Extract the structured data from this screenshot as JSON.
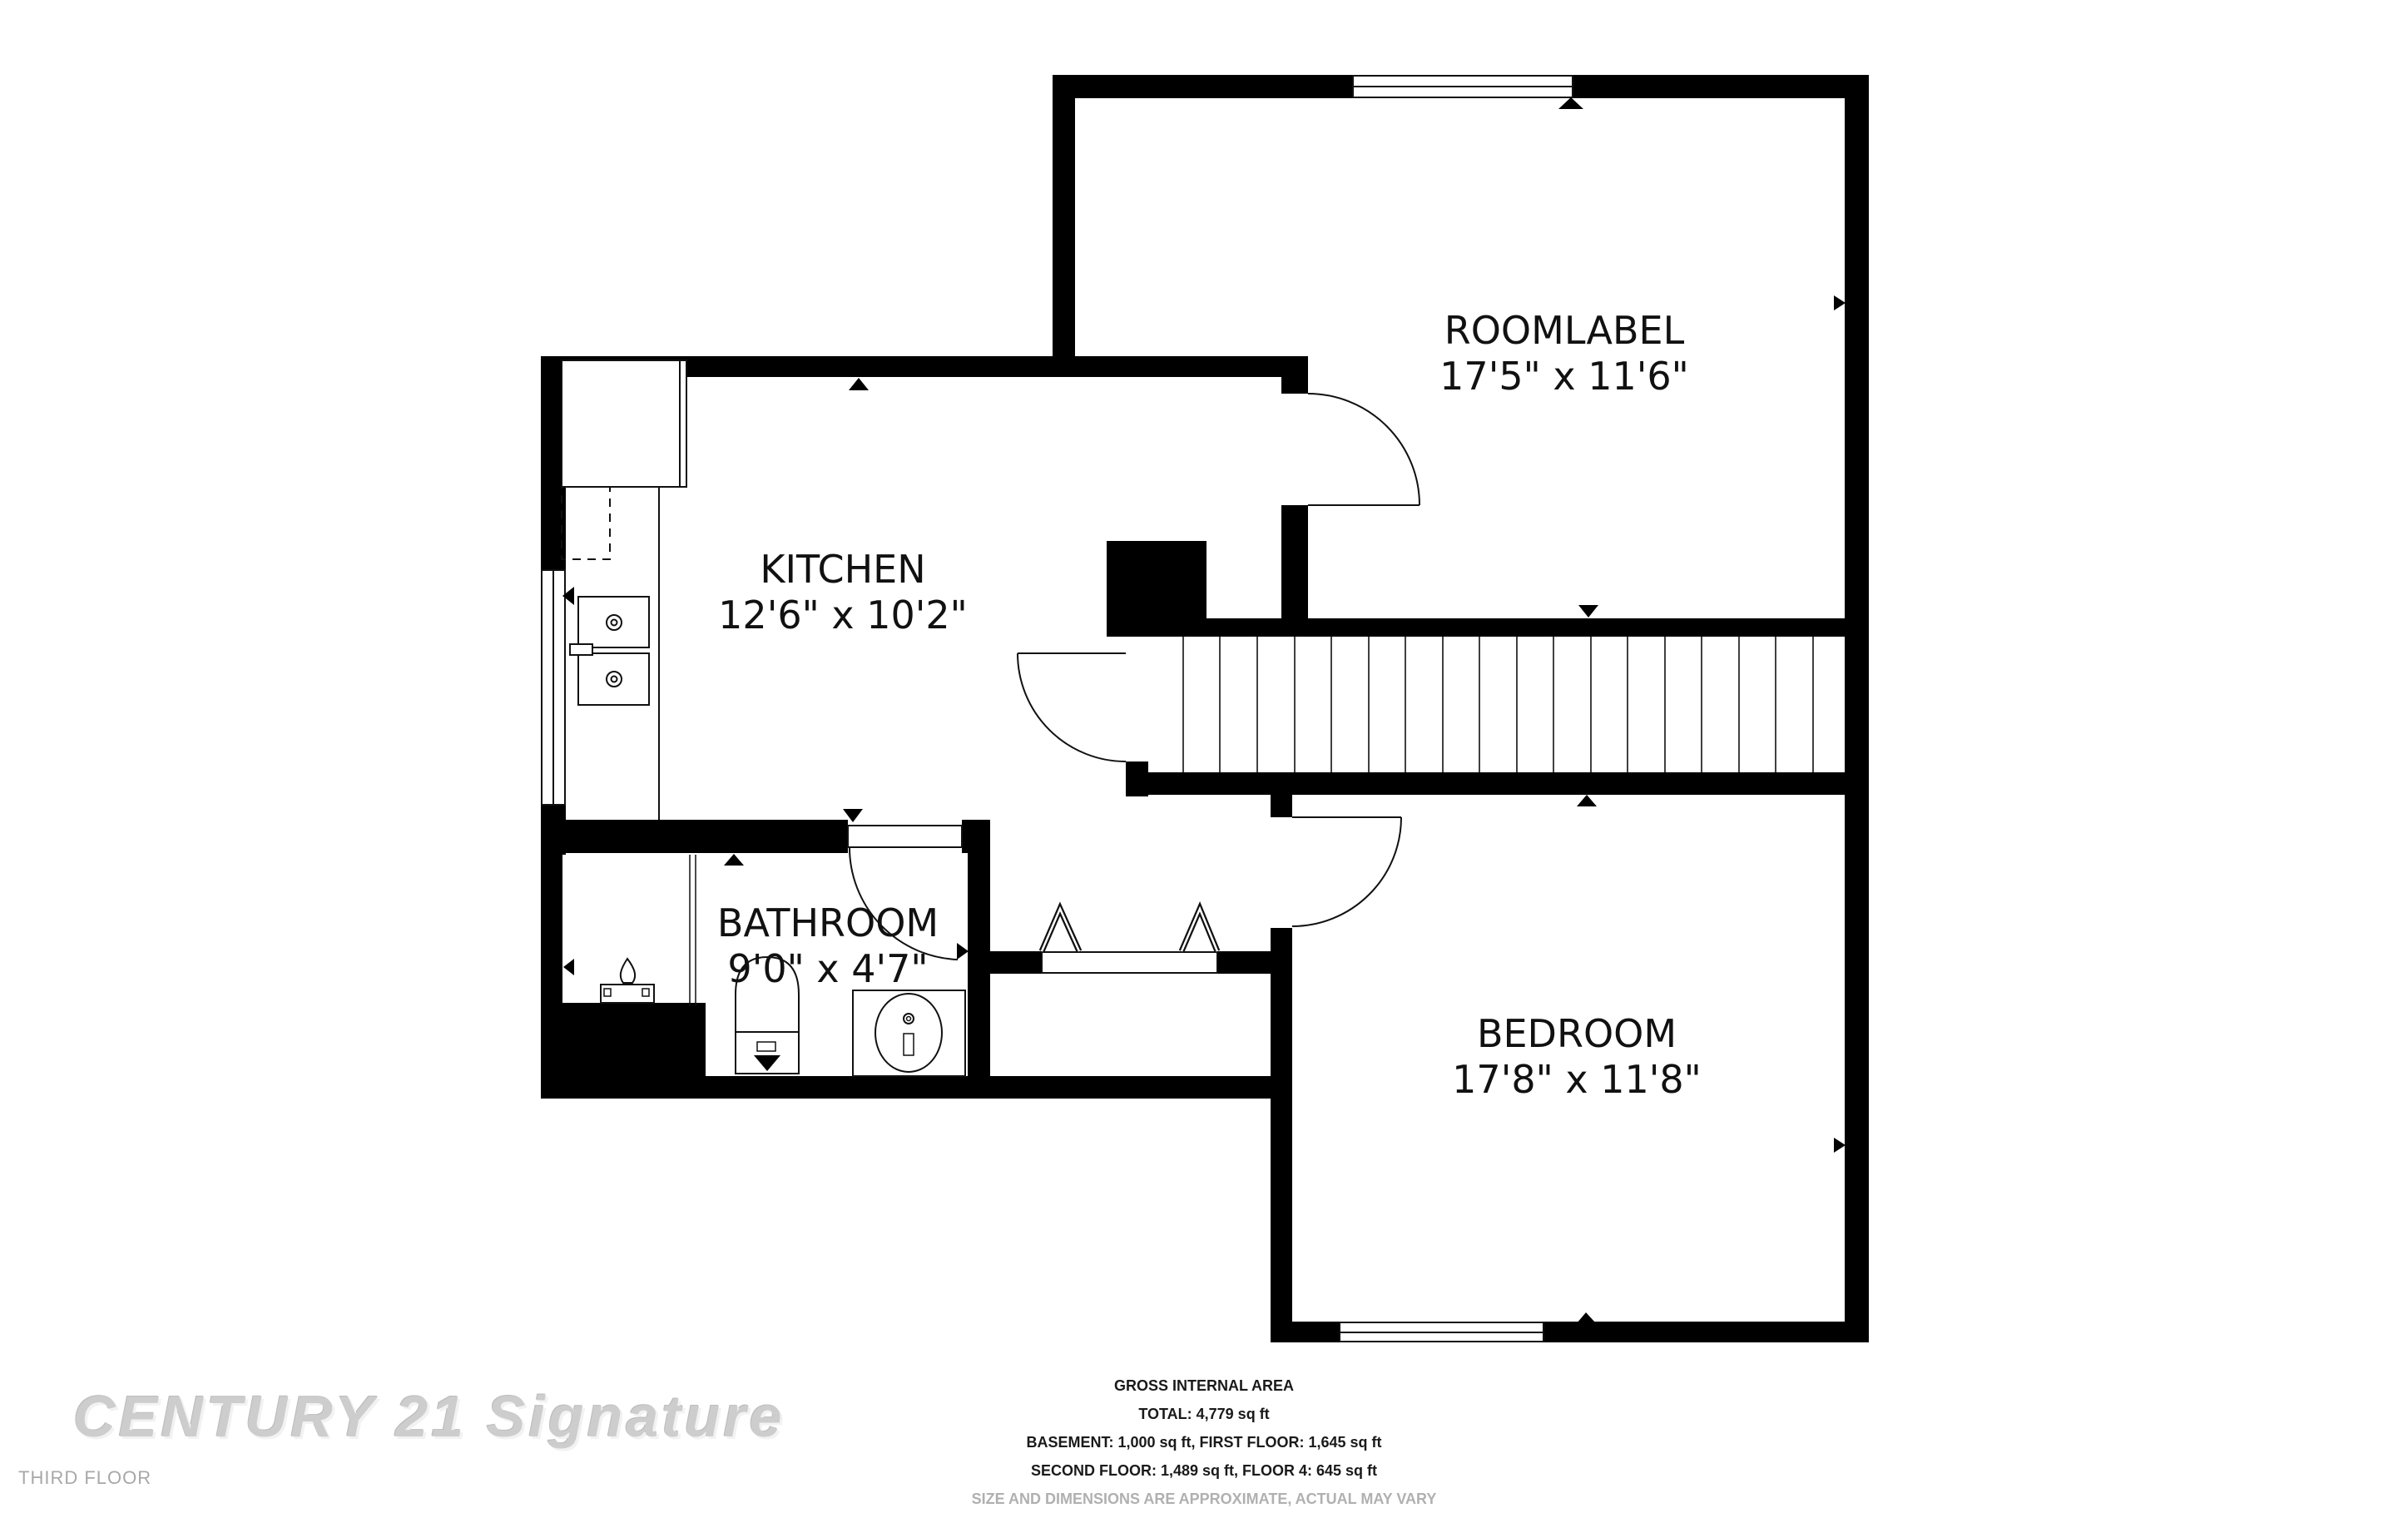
{
  "rooms": [
    {
      "name": "ROOMLABEL",
      "dims": "17'5\" x 11'6\""
    },
    {
      "name": "KITCHEN",
      "dims": "12'6\" x 10'2\""
    },
    {
      "name": "BATHROOM",
      "dims": "9'0\" x 4'7\""
    },
    {
      "name": "BEDROOM",
      "dims": "17'8\" x 11'8\""
    }
  ],
  "watermark": "CENTURY 21 Signature",
  "floor_label": "THIRD FLOOR",
  "area_summary": {
    "heading": "GROSS INTERNAL AREA",
    "total": "TOTAL: 4,779 sq ft",
    "line_basement_first": "BASEMENT: 1,000 sq ft, FIRST FLOOR: 1,645 sq ft",
    "line_second_fourth": "SECOND FLOOR: 1,489 sq ft, FLOOR 4: 645 sq ft",
    "disclaimer": "SIZE AND DIMENSIONS ARE APPROXIMATE, ACTUAL MAY VARY"
  },
  "colors": {
    "wall": "#000000",
    "background": "#ffffff",
    "line": "#111111",
    "watermark": "#cdcdcd",
    "muted_text": "#b0b0b0"
  }
}
